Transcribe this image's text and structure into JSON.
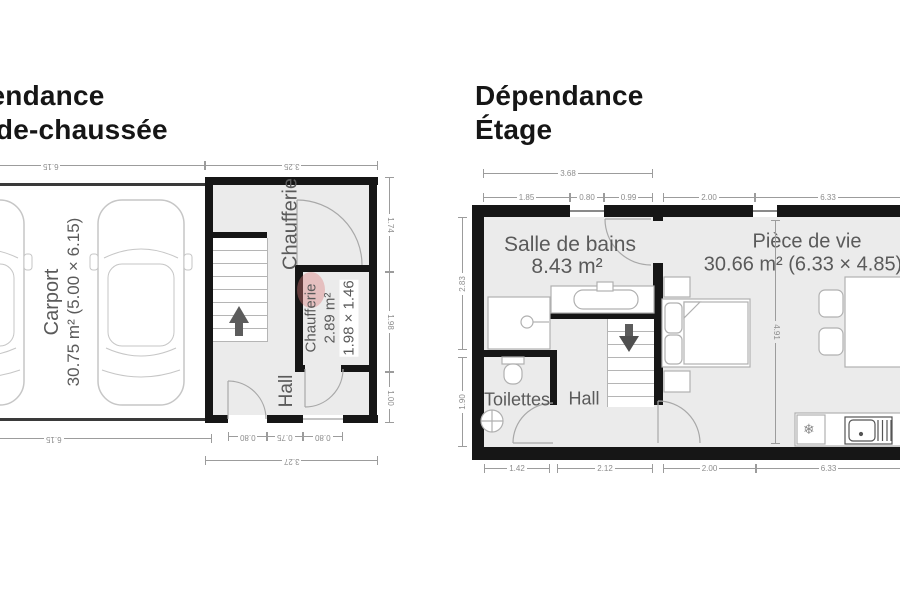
{
  "left_plan": {
    "title_line1": "Dépendance",
    "title_line2": "Rez-de-chaussée",
    "carport": {
      "name": "Carport",
      "details": "30.75 m² (5.00 × 6.15)"
    },
    "chaufferie_room_label": "Chaufferie",
    "chaufferie": {
      "name": "Chaufferie",
      "area": "2.89 m²",
      "dims": "1.98 × 1.46"
    },
    "hall_label": "Hall",
    "dims": {
      "carport_top": "6.15",
      "block_top": "3.25",
      "right_upper": "1.74",
      "right_middle": "1.98",
      "right_lower": "1.00",
      "bottom_door": "0.80",
      "bottom_pier": "0.75",
      "bottom_window": "0.80",
      "bottom_total": "3.27",
      "carport_bottom": "6.15"
    }
  },
  "right_plan": {
    "title_line1": "Dépendance",
    "title_line2": "Étage",
    "salle_de_bains": {
      "name": "Salle de bains",
      "area": "8.43 m²"
    },
    "piece_de_vie": {
      "name": "Pièce de vie",
      "details": "30.66 m² (6.33 × 4.85)"
    },
    "toilettes_label": "Toilettes",
    "hall_label": "Hall",
    "dims": {
      "top_total": "3.68",
      "top_seg1": "1.85",
      "top_seg2": "0.80",
      "top_seg3": "0.99",
      "top_seg4": "2.00",
      "top_seg5": "6.33",
      "left_upper": "2.83",
      "left_lower": "1.90",
      "interior_height": "4.91",
      "bottom_seg1": "1.42",
      "bottom_seg2": "2.12",
      "bottom_seg3": "2.00",
      "bottom_seg4": "6.33"
    }
  },
  "icons": {
    "fridge_snowflake": "❄"
  },
  "colors": {
    "wall": "#161616",
    "floor": "#ebebeb",
    "dimension_text": "#8d8d8d",
    "room_label": "#5a5a5a",
    "chaufferie_highlight": "#e8bdbd"
  }
}
